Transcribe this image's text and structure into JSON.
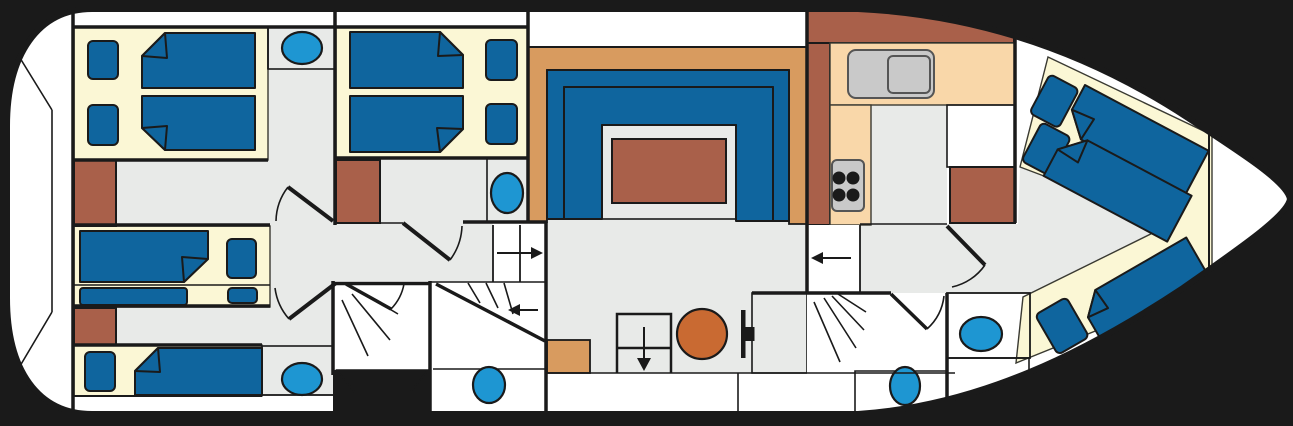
{
  "figure": {
    "kind": "boat deck floor plan, top view",
    "bow_direction": "right",
    "labels": {
      "hull": "boat hull",
      "forward_cabin_top": "forward twin cabin with two berths and washbasin",
      "mid_cabin": "twin cabin with two berths and washbasin",
      "bunk_cabin": "cabin with bunk berths",
      "single_cabin": "single berth cabin with washbasin",
      "saloon": "saloon with U-shaped sofa and table",
      "galley": "galley with sink, stove and counters",
      "aft_cabin": "aft cabin with three angled berths",
      "shower_1": "shower room with WC",
      "shower_2": "shower room with WC",
      "wc_room": "toilet room",
      "basin_room": "washbasin room",
      "helm": "helm area with wheel and round stool",
      "stairs_up": "companionway steps, arrow right",
      "stairs_curved": "curved steps, arrow left",
      "stairs_down": "steps down, arrow down",
      "stairs_aft": "steps, arrow left",
      "wardrobe": "wardrobe cabinet",
      "table": "saloon table",
      "round_stool": "round stool",
      "wheel": "steering wheel",
      "sink": "galley sink with drainer",
      "stove": "four burner stove",
      "berth": "berth mattress with folded corner",
      "pillow": "pillow",
      "washbasin": "washbasin",
      "toilet": "toilet"
    },
    "inventory": {
      "berths_total": 10,
      "pillows_total": 9,
      "washbasins": 4,
      "toilets": 2,
      "shower_rooms": 2,
      "wardrobes": 4,
      "stair_symbols": 4,
      "tables": 2,
      "stoves": 1,
      "galley_sinks": 1
    }
  },
  "colors": {
    "background": "#000000",
    "hull_fill": "#FFFFFF",
    "outline": "#1A1A1A",
    "floor": "#E8EAE8",
    "floor_light": "#EFEFEF",
    "inset_gray": "#EBEDEB",
    "berth_base": "#FBF7D5",
    "mattress": "#0F659E",
    "fixture_blue": "#1E96D2",
    "wood_brick": "#A9604A",
    "wood_tan": "#D89B5F",
    "counter_peach": "#F9D7A9",
    "appliance_gray": "#C9C9C9",
    "table_round_orange": "#C96A32"
  }
}
